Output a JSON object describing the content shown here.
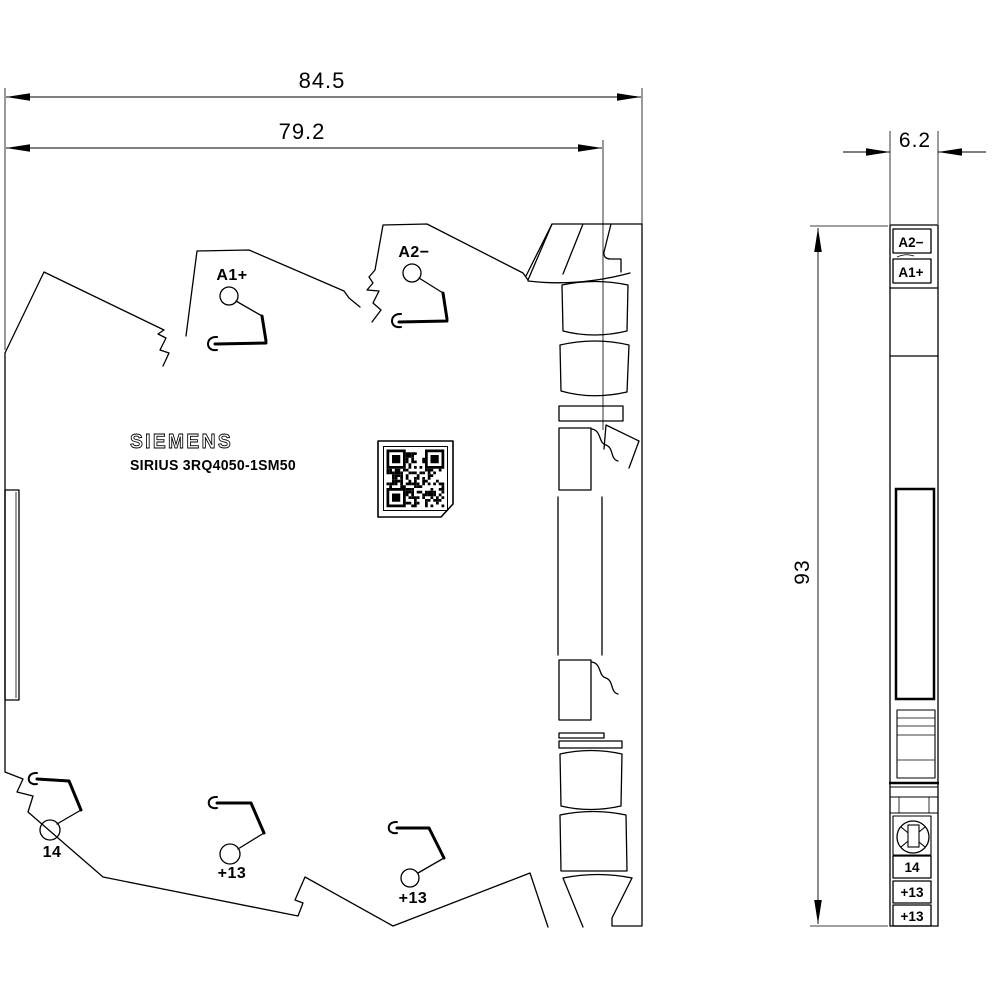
{
  "brand": "SIEMENS",
  "product_code": "SIRIUS 3RQ4050-1SM50",
  "dimensions": {
    "overall_width": "84.5",
    "housing_width": "79.2",
    "depth": "6.2",
    "height": "93"
  },
  "side_view": {
    "terminals": [
      "A1+",
      "A2−",
      "14",
      "+13",
      "+13"
    ]
  },
  "front_view": {
    "labels": [
      "A2−",
      "A1+",
      "14",
      "+13",
      "+13"
    ]
  },
  "icons": {
    "qr": "qr-code"
  },
  "colors": {
    "line": "#000000",
    "background": "#ffffff"
  }
}
